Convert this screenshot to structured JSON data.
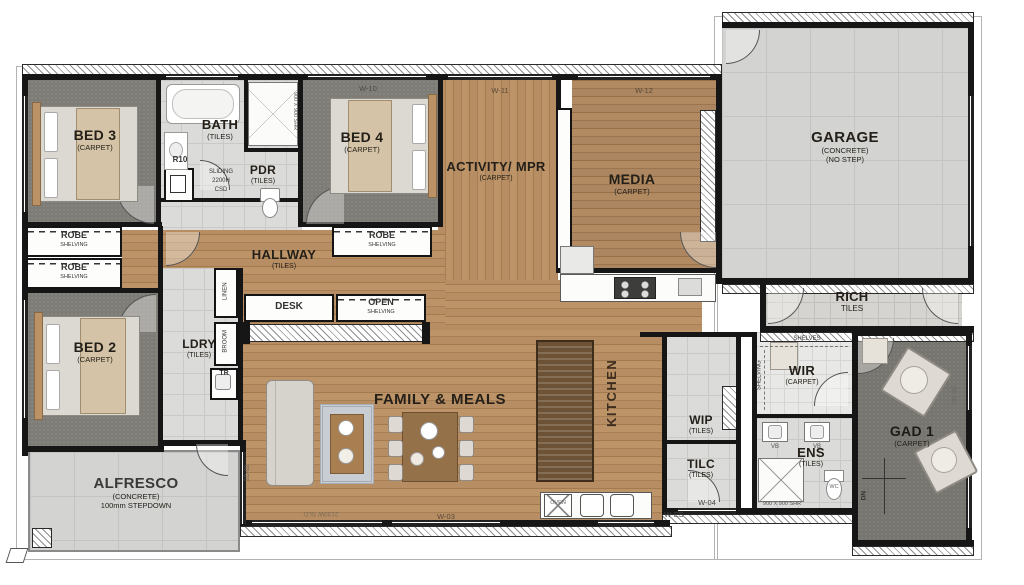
{
  "rooms": {
    "bed3": {
      "name": "BED 3",
      "floor": "(CARPET)"
    },
    "bath": {
      "name": "BATH",
      "floor": "(TILES)"
    },
    "pdr": {
      "name": "PDR",
      "floor": "(TILES)"
    },
    "bed4": {
      "name": "BED 4",
      "floor": "(CARPET)"
    },
    "activity": {
      "name": "ACTIVITY/ MPR",
      "floor": "(CARPET)"
    },
    "media": {
      "name": "MEDIA",
      "floor": "(CARPET)"
    },
    "garage": {
      "name": "GARAGE",
      "floor": "(CONCRETE)",
      "note": "(NO STEP)"
    },
    "porch": {
      "name": "RICH",
      "floor": "TILES"
    },
    "hallway": {
      "name": "HALLWAY",
      "floor": "(TILES)"
    },
    "bed2": {
      "name": "BED 2",
      "floor": "(CARPET)"
    },
    "ldry": {
      "name": "LDRY",
      "floor": "(TILES)"
    },
    "family": {
      "name": "FAMILY & MEALS"
    },
    "kitchen": {
      "name": "KITCHEN"
    },
    "wip": {
      "name": "WIP",
      "floor": "(TILES)"
    },
    "tilc": {
      "name": "TILC",
      "floor": "(TILES)"
    },
    "wir": {
      "name": "WIR",
      "floor": "(CARPET)"
    },
    "ens": {
      "name": "ENS",
      "floor": "(TILES)"
    },
    "bed1": {
      "name": "GAD 1",
      "floor": "(CARPET)"
    },
    "alfresco": {
      "name": "ALFRESCO",
      "floor": "(CONCRETE)",
      "note": "100mm STEPDOWN"
    }
  },
  "storage": {
    "robe_a": {
      "name": "ROBE",
      "sub": "SHELVING"
    },
    "robe_b": {
      "name": "ROBE",
      "sub": "SHELVING"
    },
    "robe_c": {
      "name": "ROBE",
      "sub": "SHELVING"
    },
    "desk": "DESK",
    "open_shelving": {
      "name": "OPEN",
      "sub": "SHELVING"
    },
    "linen": "LINEN",
    "broom": "BROOM",
    "shelves": "SHELVES",
    "shelving": "SHELVING"
  },
  "fixtures": {
    "r10": "R10",
    "csd_line1": "SLIDING",
    "csd_line2": "2200H",
    "csd_line3": "CSD",
    "shower_bath": "900 X 900 SHR",
    "shower_ens": "900 X 900 SHR",
    "tr": "TR",
    "wc": "WC",
    "vb1": "VB",
    "vb2": "VB",
    "oven": "OVEN",
    "dn": "DN"
  },
  "openings": {
    "w10": "W-10",
    "w11": "W-11",
    "w12": "W-12",
    "w03": "W-03",
    "w_es": "W-ES",
    "w04": "W-04",
    "w16": "(W-16)",
    "sd02": "SD-02",
    "slider": "2130W SLD"
  },
  "colors": {
    "timber": "#b3895e",
    "carpet": "#77756f",
    "tiles": "#dbdbd9",
    "concrete": "#d3d3d1",
    "wall": "#161616"
  }
}
